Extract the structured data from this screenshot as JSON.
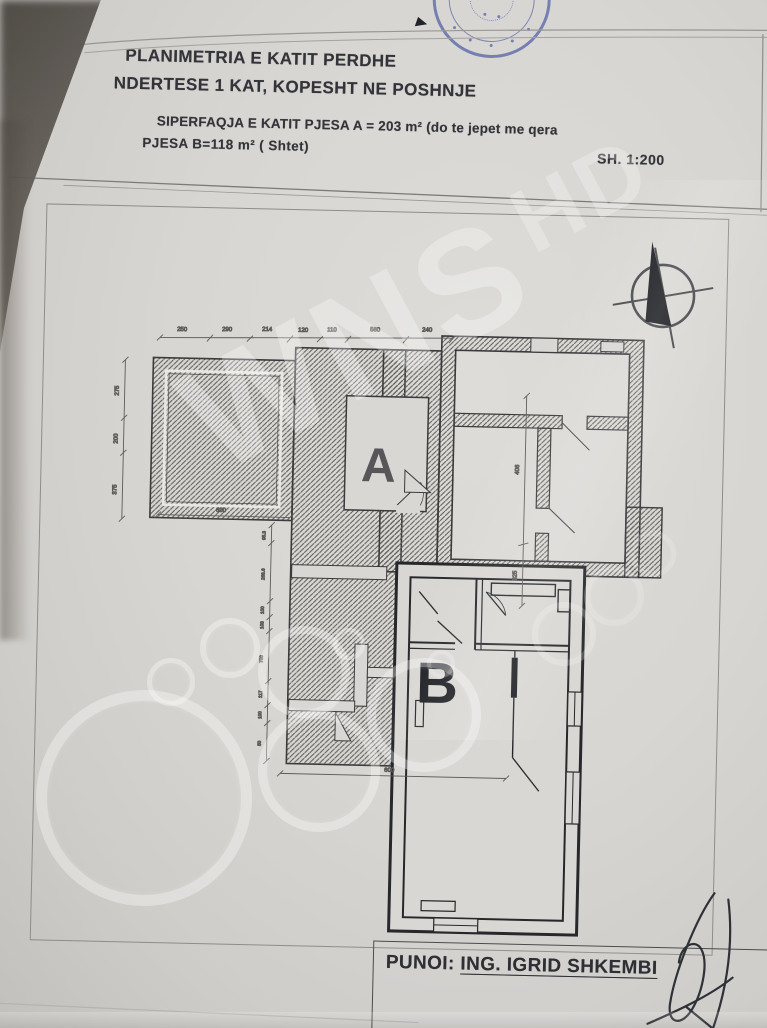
{
  "photo": {
    "paper_color": "#d8d6d2",
    "stamp_color": "#3c4da0",
    "ink_color": "#33343a"
  },
  "header": {
    "title_line1": "PLANIMETRIA E KATIT PERDHE",
    "title_line2": "NDERTESE 1 KAT, KOPESHT NE POSHNJE",
    "area_line1": "SIPERFAQJA E KATIT PJESA  A  = 203 m²  (do te jepet me qera",
    "area_line2": "PJESA B=118 m²   ( Shtet)",
    "scale": "SH. 1:200"
  },
  "plan": {
    "label_part_a": "A",
    "label_part_b": "B",
    "dims_top": [
      "250",
      "290",
      "214",
      "120",
      "110",
      "560",
      "240"
    ],
    "dims_left": [
      "275",
      "200",
      "375"
    ],
    "dims_middle": [
      "95.3",
      "268.6",
      "100",
      "103",
      "700",
      "117",
      "100",
      "50"
    ],
    "dims_right": [
      "406",
      "325"
    ],
    "dim_bottom_left": "600",
    "dim_bottom_middle": "600"
  },
  "footer": {
    "author_label": "PUNOI:",
    "author_name": "ING. IGRID SHKEMBI"
  },
  "watermark": {
    "main": "WNS",
    "sub": "HD"
  }
}
